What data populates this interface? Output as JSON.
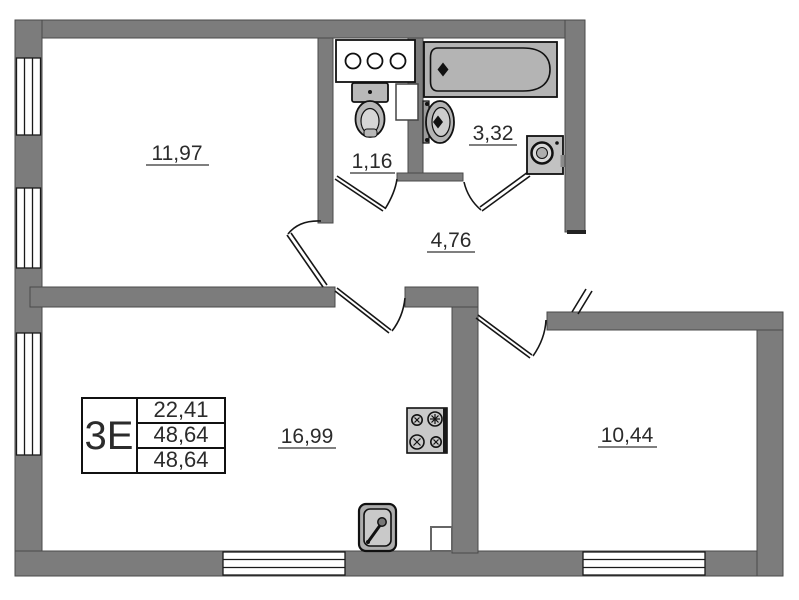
{
  "plan": {
    "unit_label": "3E",
    "info_table": {
      "rows": [
        "22,41",
        "48,64",
        "48,64"
      ]
    },
    "rooms": [
      {
        "id": "living-room",
        "area": "11,97"
      },
      {
        "id": "wc",
        "area": "1,16"
      },
      {
        "id": "bathroom",
        "area": "3,32"
      },
      {
        "id": "hallway",
        "area": "4,76"
      },
      {
        "id": "kitchen-living",
        "area": "16,99"
      },
      {
        "id": "bedroom",
        "area": "10,44"
      }
    ],
    "fixtures": [
      "bathtub",
      "bathroom-sink",
      "toilet",
      "vanity-counter",
      "washing-machine",
      "stove",
      "kitchen-sink"
    ],
    "colors": {
      "wall": "#7c7c7c",
      "fixture": "#b8b8b8",
      "line": "#161616",
      "background": "#ffffff"
    }
  }
}
